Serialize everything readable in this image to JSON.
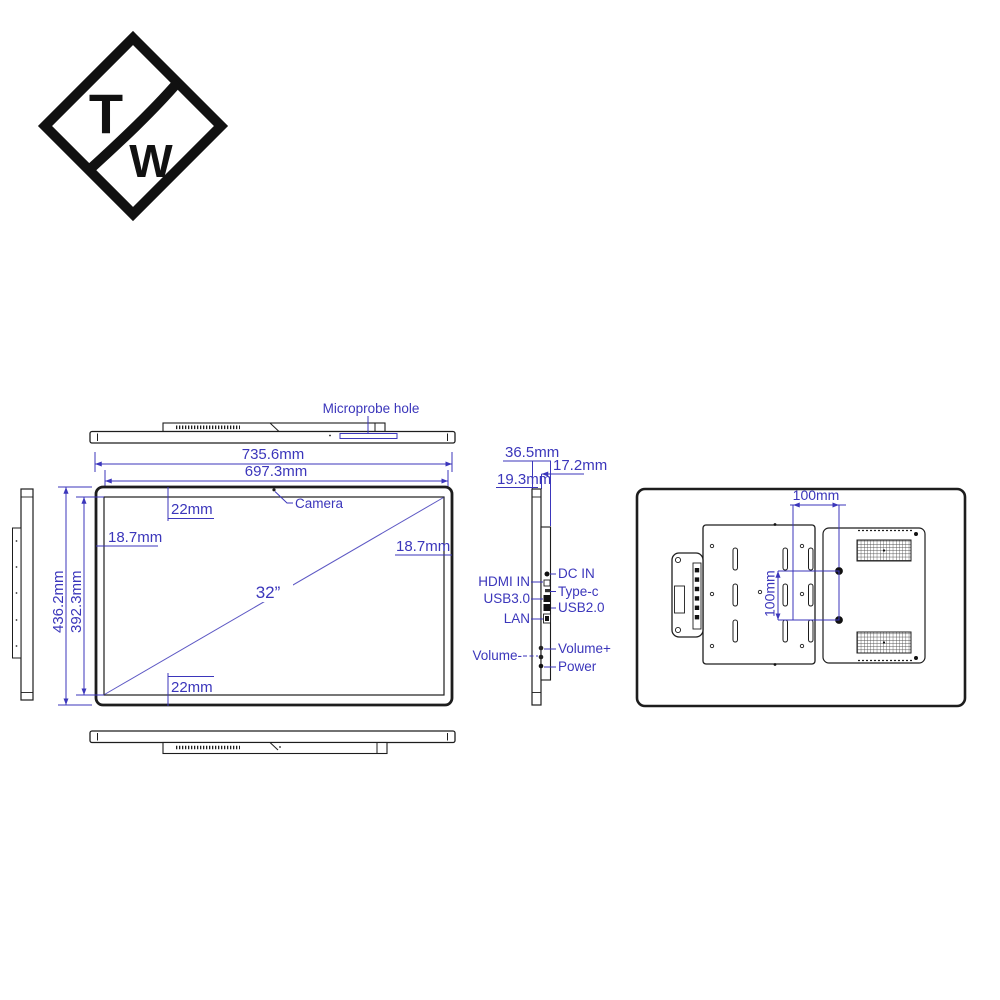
{
  "colors": {
    "accent": "#3b36bb",
    "line": "#1d1d1d",
    "background": "#ffffff"
  },
  "logo": {
    "top_letter": "T",
    "bottom_letter": "W"
  },
  "views": {
    "top": {
      "label": "Microprobe hole"
    },
    "front": {
      "outer_width": "735.6mm",
      "inner_width": "697.3mm",
      "outer_height": "436.2mm",
      "inner_height": "392.3mm",
      "top_offset": "22mm",
      "bottom_offset": "22mm",
      "left_offset": "18.7mm",
      "right_offset": "18.7mm",
      "diagonal_size": "32”",
      "camera": "Camera"
    },
    "side": {
      "total_depth": "36.5mm",
      "back_depth": "17.2mm",
      "front_depth": "19.3mm",
      "left_labels": [
        "HDMI IN",
        "USB3.0",
        "LAN",
        "Volume-"
      ],
      "right_labels": [
        "DC IN",
        "Type-c",
        "USB2.0",
        "Volume+",
        "Power"
      ]
    },
    "back": {
      "vesa_horizontal": "100mm",
      "vesa_vertical": "100mm"
    }
  }
}
